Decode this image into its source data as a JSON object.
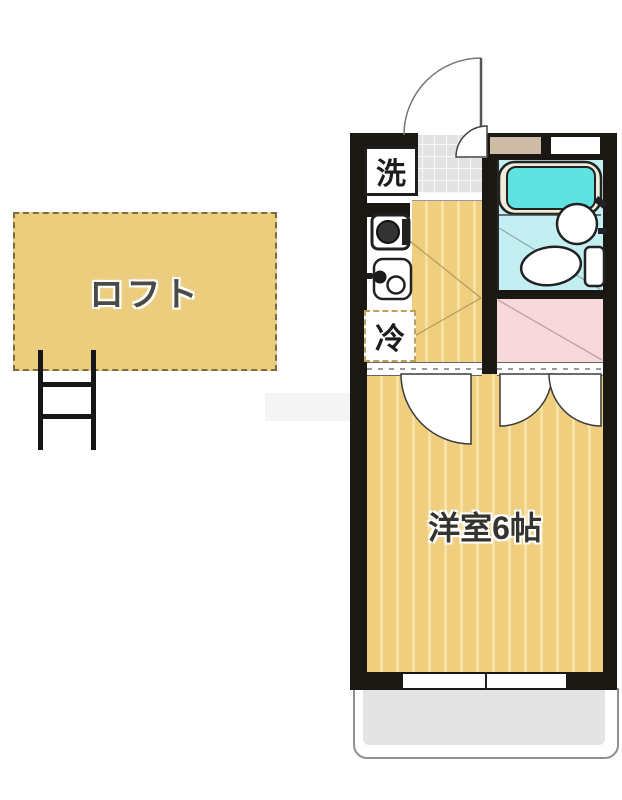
{
  "title": "1K apartment floor plan with loft",
  "labels": {
    "loft": "ロフト",
    "main_room": "洋室6帖",
    "laundry": "洗",
    "refrigerator": "冷"
  },
  "colors": {
    "wall": "#1b1713",
    "floor-tan": "#efce7d",
    "floor-stripe": "#f6e2a4",
    "loft-fill": "#eccd7e",
    "closet-pink": "#f8d8db",
    "bath-floor": "#c3eef2",
    "tub-teal": "#5fe2e0",
    "tub-rim": "#f0ecd8",
    "entry-tile": "#e2e2e2",
    "balcony-gray": "#e4e4e5",
    "wall-beige": "#cdbba6",
    "line-brown": "#b49a5e"
  }
}
